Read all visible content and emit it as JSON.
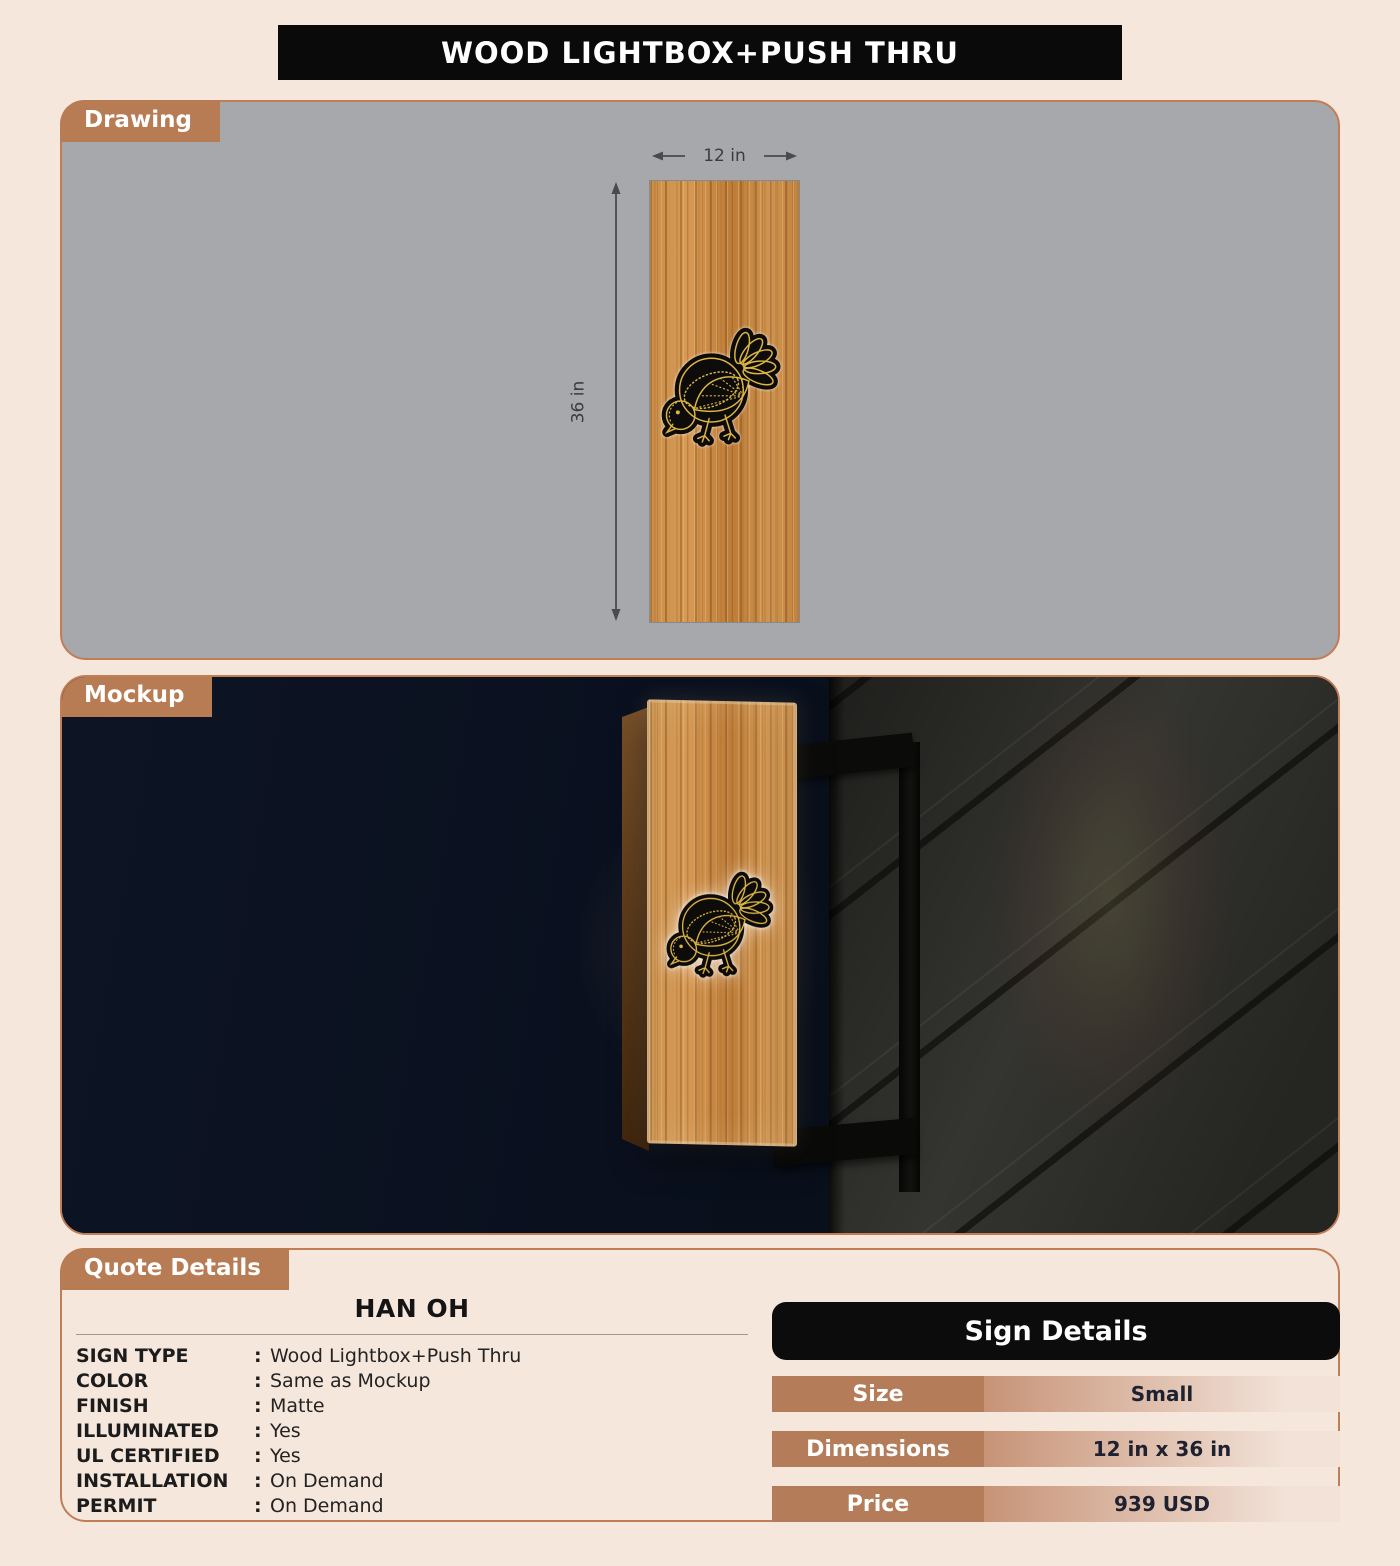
{
  "title": "WOOD LIGHTBOX+PUSH THRU",
  "sections": {
    "drawing_label": "Drawing",
    "mockup_label": "Mockup",
    "quote_label": "Quote Details"
  },
  "drawing": {
    "width_label": "12 in",
    "height_label": "36 in"
  },
  "quote": {
    "customer": "HAN OH",
    "colon": ":",
    "specs": [
      {
        "label": "SIGN TYPE",
        "value": "Wood Lightbox+Push Thru"
      },
      {
        "label": "COLOR",
        "value": "Same as Mockup"
      },
      {
        "label": "FINISH",
        "value": "Matte"
      },
      {
        "label": "ILLUMINATED",
        "value": "Yes"
      },
      {
        "label": "UL CERTIFIED",
        "value": "Yes"
      },
      {
        "label": "INSTALLATION",
        "value": "On Demand"
      },
      {
        "label": "PERMIT",
        "value": "On Demand"
      }
    ]
  },
  "sign_details": {
    "title": "Sign Details",
    "rows": [
      {
        "label": "Size",
        "value": "Small"
      },
      {
        "label": "Dimensions",
        "value": "12 in x 36 in"
      },
      {
        "label": "Price",
        "value": "939 USD"
      }
    ]
  },
  "colors": {
    "accent_brown": "#b87c55",
    "panel_border": "#c07e57",
    "panel_gray": "#a7a8ac",
    "header_black": "#0a0a0a",
    "background_cream": "#f6e7dd",
    "wood_base": "#c5863f",
    "logo_gold": "#dcb544",
    "mockup_night": "#0a0f1c"
  }
}
